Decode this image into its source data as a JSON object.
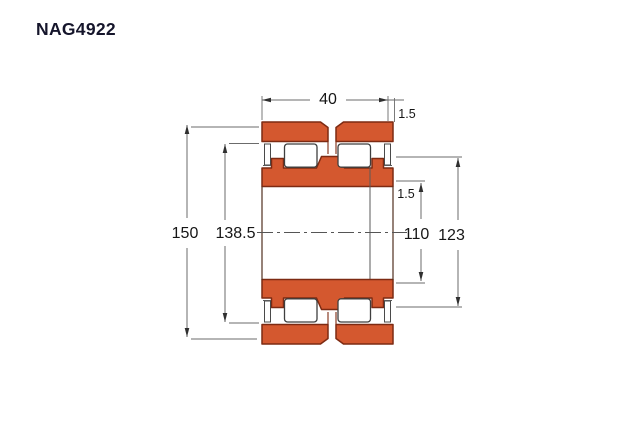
{
  "title": "NAG4922",
  "drawing": {
    "dimensions": {
      "width": "40",
      "outer_chamfer": "1.5",
      "outer_diameter": "150",
      "outer_raceway_diameter": "138.5",
      "inner_chamfer": "1.5",
      "bore_diameter": "110",
      "rib_diameter": "123"
    },
    "colors": {
      "ring_fill": "#d4582f",
      "ring_stroke": "#7d2a12",
      "dim_line": "#6b6b6b",
      "dim_text": "#161616",
      "title_text": "#15152b",
      "background": "#ffffff"
    }
  }
}
